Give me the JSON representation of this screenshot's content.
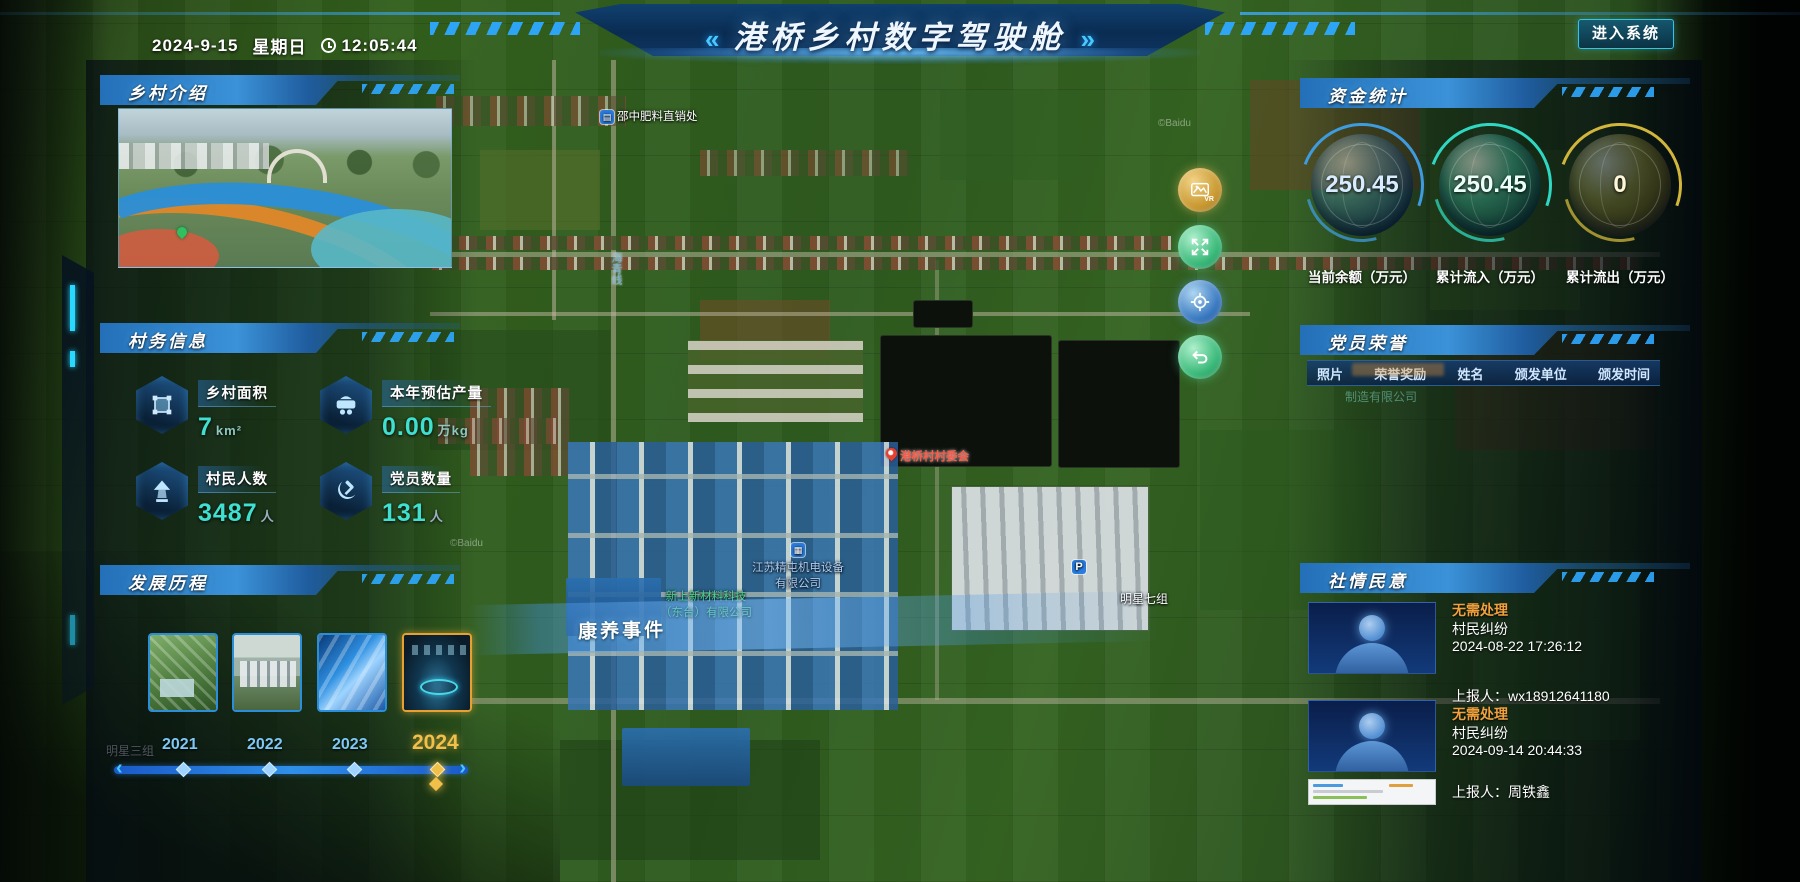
{
  "header": {
    "date": "2024-9-15",
    "weekday": "星期日",
    "time": "12:05:44",
    "title": "港桥乡村数字驾驶舱",
    "chevron_left": "«",
    "chevron_right": "»",
    "enter_button": "进入系统"
  },
  "intro": {
    "title": "乡村介绍"
  },
  "village_info": {
    "title": "村务信息",
    "stats": [
      {
        "icon": "area-icon",
        "label": "乡村面积",
        "value": "7",
        "unit": "km²"
      },
      {
        "icon": "cart-icon",
        "label": "本年预估产量",
        "value": "0.00",
        "unit": "万kg"
      },
      {
        "icon": "villager-icon",
        "label": "村民人数",
        "value": "3487",
        "unit": "人"
      },
      {
        "icon": "party-icon",
        "label": "党员数量",
        "value": "131",
        "unit": "人"
      }
    ]
  },
  "development": {
    "title": "发展历程",
    "years": [
      {
        "label": "2021"
      },
      {
        "label": "2022"
      },
      {
        "label": "2023"
      },
      {
        "label": "2024"
      }
    ],
    "selected_year": "2024"
  },
  "funds": {
    "title": "资金统计",
    "gauges": [
      {
        "value": "250.45",
        "label": "当前余额（万元）",
        "color": "#3f9be0"
      },
      {
        "value": "250.45",
        "label": "累计流入（万元）",
        "color": "#2fd8c2"
      },
      {
        "value": "0",
        "label": "累计流出（万元）",
        "color": "#d2b63c"
      }
    ]
  },
  "honors": {
    "title": "党员荣誉",
    "columns": [
      "照片",
      "荣誉奖励",
      "姓名",
      "颁发单位",
      "颁发时间"
    ],
    "ghost_row_text": "制造有限公司"
  },
  "opinions": {
    "title": "社情民意",
    "items": [
      {
        "status": "无需处理",
        "type": "村民纠纷",
        "time": "2024-08-22 17:26:12",
        "reporter": "上报人：wx18912641180"
      },
      {
        "status": "无需处理",
        "type": "村民纠纷",
        "time": "2024-09-14 20:44:33",
        "reporter": "上报人：周铁鑫"
      }
    ]
  },
  "map": {
    "event_label": "康养事件",
    "poi_fertilizer": "邵中肥料直销处",
    "poi_committee": "港桥村村委会",
    "company1_line1": "江苏精屯机电设备",
    "company1_line2": "有限公司",
    "company2_line1": "新上新材料科技",
    "company2_line2": "（东台）有限公司",
    "group7": "明星七组",
    "group3": "明星三组",
    "road_label": "海青线",
    "parking": "P",
    "vr_label": "VR",
    "watermark": "©Baidu",
    "slider_left": "‹",
    "slider_right": "›"
  }
}
